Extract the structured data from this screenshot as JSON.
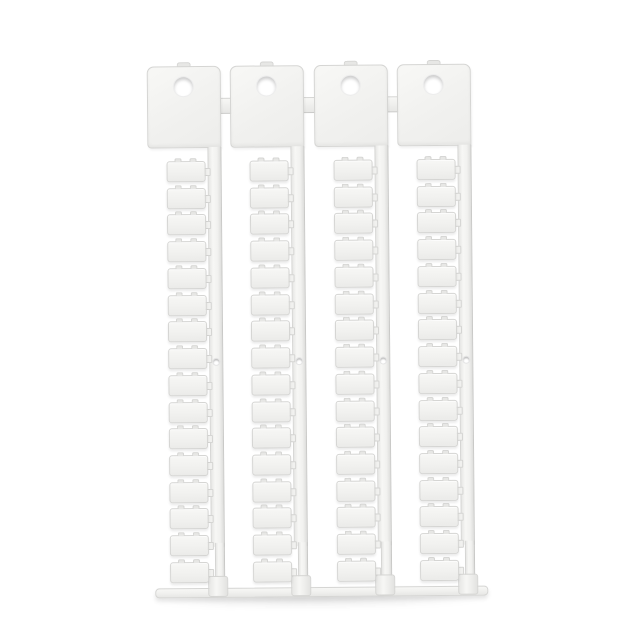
{
  "photo": {
    "subject": "product-photo-blank-wire-marker-tag-sprues",
    "background": "#ffffff"
  },
  "sprue": {
    "strip_count": 4,
    "tags_per_strip": 16,
    "header_link_tabs": 3,
    "header_holes_per_strip": 1,
    "spine_holes_per_strip": 1,
    "bottom_runner_bars": 1
  },
  "colors": {
    "background": "#ffffff",
    "plastic": "#f1f1ef",
    "plastic_light": "#f7f7f5",
    "plastic_dark": "#e7e7e5",
    "edge": "#d5d5d3",
    "edge_dark": "#c9c9c7",
    "hole_fill": "#ffffff",
    "cast_shadow": "rgba(70,70,70,0.13)"
  }
}
